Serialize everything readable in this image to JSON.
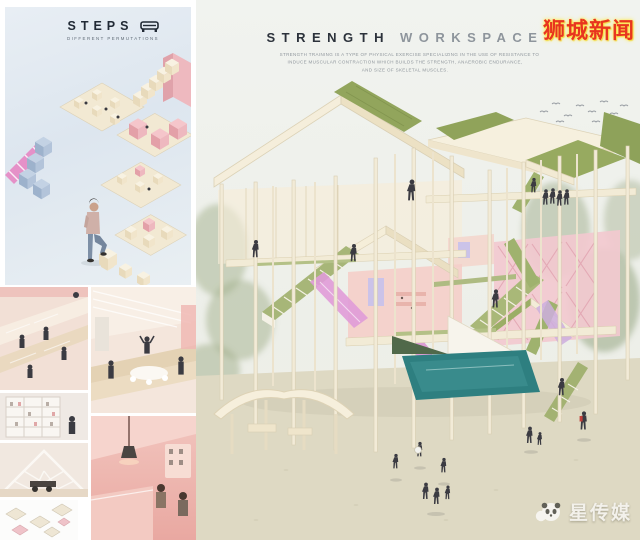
{
  "left_panel": {
    "title": "STEPS",
    "subtitle": "DIFFERENT PERMUTATIONS",
    "logo_icon": "steps-bench-icon"
  },
  "main_panel": {
    "title_primary": "STRENGTH",
    "title_secondary": "WORKSPACE",
    "subtitle_lines": [
      "STRENGTH TRAINING IS A TYPE OF PHYSICAL EXERCISE SPECIALIZING IN THE USE OF RESISTANCE TO",
      "INDUCE MUSCULAR CONTRACTION WHICH BUILDS THE STRENGTH, ANAEROBIC ENDURANCE,",
      "AND SIZE OF SKELETAL MUSCLES."
    ]
  },
  "watermarks": {
    "top_right": "狮城新闻",
    "bottom_right": "星传媒",
    "bottom_right_icon": "panda-mascot-icon"
  },
  "colors": {
    "steps_panel_bg": "#dde6ef",
    "title_dark": "#2c323b",
    "title_gray": "#8e959c",
    "sky": "#eef0ea",
    "ground": "#ded9c3",
    "timber_cream": "#f2ebd7",
    "green_roof": "#92a55c",
    "stair_green": "#a9b878",
    "pink_wall": "#f2c9cf",
    "magenta_ramp": "#e09bd8",
    "lavender": "#cbc3e9",
    "pool_teal": "#2e7f80",
    "watermark_red": "#e8351f",
    "watermark_glow": "#ffe84d",
    "watermark_white": "#f4f3ee"
  }
}
